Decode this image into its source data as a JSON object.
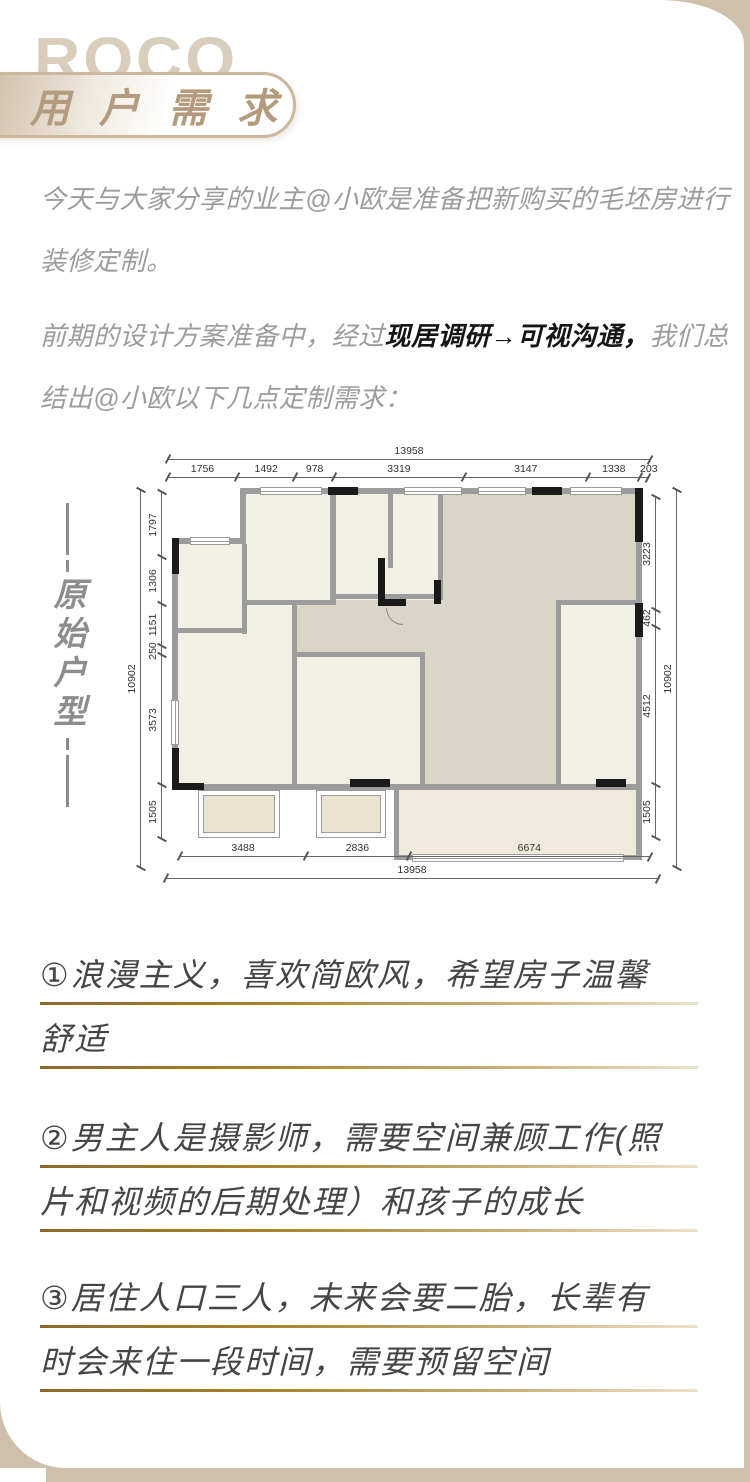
{
  "brand": {
    "logo_text": "ROCO"
  },
  "header": {
    "badge": "用 户 需 求"
  },
  "intro": {
    "p1": "今天与大家分享的业主@小欧是准备把新购买的毛坯房进行装修定制。",
    "p2_pre": "前期的设计方案准备中，经过",
    "p2_bold": "现居调研→可视沟通，",
    "p2_post": "我们总结出@小欧以下几点定制需求："
  },
  "floorplan": {
    "section_label": "原始户型",
    "dims": {
      "top_total": "13958",
      "top_segments": [
        "1756",
        "1492",
        "978",
        "3319",
        "3147",
        "1338",
        "203"
      ],
      "left_total": "10902",
      "left_segments": [
        "1797",
        "1306",
        "1151",
        "250",
        "3573",
        "1505"
      ],
      "right_total": "10902",
      "right_segments": [
        "3223",
        "462",
        "4512",
        "1505"
      ],
      "bottom_segments": [
        "3488",
        "2836",
        "6674"
      ],
      "bottom_total": "13958"
    }
  },
  "requirements": [
    {
      "lines": [
        "①浪漫主义，喜欢简欧风，希望房子温馨",
        "舒适"
      ]
    },
    {
      "lines": [
        "②男主人是摄影师，需要空间兼顾工作(照",
        "片和视频的后期处理）和孩子的成长"
      ]
    },
    {
      "lines": [
        "③居住人口三人，未来会要二胎，长辈有",
        "时会来住一段时间，需要预留空间"
      ]
    }
  ],
  "colors": {
    "background_tan": "#cfc0ab",
    "accent_gold": "#a8842e",
    "body_text_gray": "#9c9c9c",
    "wall_gray": "#9c9c9c",
    "hall_beige": "#dbd5c7",
    "room_cream": "#f2efe4"
  }
}
